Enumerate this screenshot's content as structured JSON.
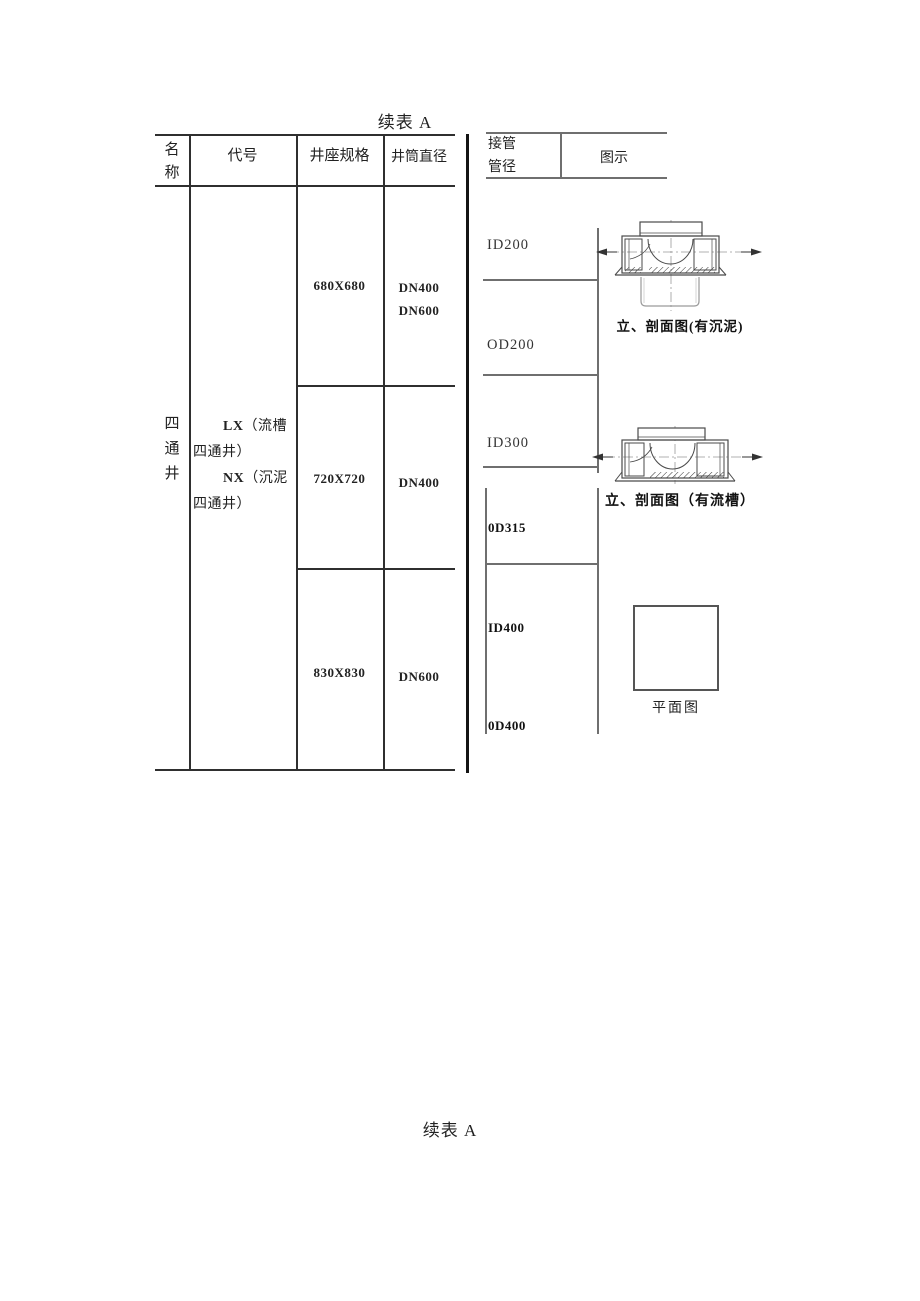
{
  "page": {
    "continuation_title_top": "续表 A",
    "continuation_title_bottom": "续表 A"
  },
  "left_table": {
    "header": {
      "name_line1": "名",
      "name_line2": "称",
      "code": "代号",
      "seat_spec": "井座规格",
      "shaft_diameter": "井筒直径"
    },
    "category_chars": [
      "四",
      "通",
      "井"
    ],
    "codes": [
      {
        "code": "LX",
        "desc": "（流槽四通井）"
      },
      {
        "code": "NX",
        "desc": "（沉泥四通井）"
      }
    ],
    "rows": [
      {
        "seat_spec": "680X680",
        "shaft": [
          "DN400",
          "DN600"
        ]
      },
      {
        "seat_spec": "720X720",
        "shaft": [
          "DN400"
        ]
      },
      {
        "seat_spec": "830X830",
        "shaft": [
          "DN600"
        ]
      }
    ]
  },
  "right_table": {
    "header": {
      "pipe_line1": "接管",
      "pipe_line2": "管径",
      "illustration": "图示"
    },
    "pipe_sizes_upper": [
      "ID200",
      "OD200",
      "ID300"
    ],
    "pipe_sizes_lower": [
      "0D315",
      "ID400",
      "0D400"
    ],
    "captions": {
      "section_sump": "立、剖面图(有沉泥)",
      "section_channel": "立、剖面图（有流槽）",
      "plan": "平面图"
    }
  },
  "colors": {
    "table_line": "#2f2f2f",
    "right_line": "#6f6f6f",
    "separator": "#141414",
    "drawing_stroke": "#4a4a4a"
  }
}
